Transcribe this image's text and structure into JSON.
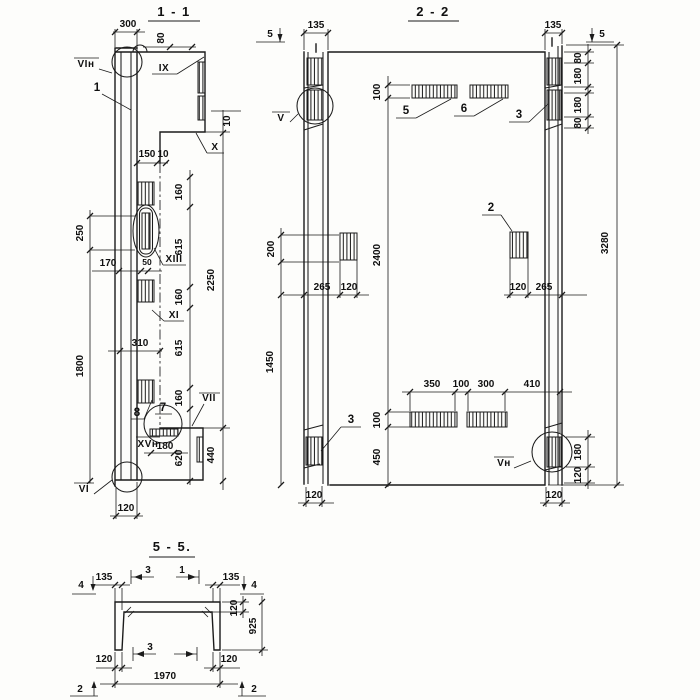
{
  "section_1_1": {
    "title": "1 - 1",
    "marks": {
      "vi_n": "VIн",
      "ix": "IX",
      "x": "X",
      "xiii": "XIII",
      "xi": "XI",
      "vii": "VII",
      "xv_n": "XVн",
      "vi": "VI"
    },
    "parts": {
      "p1": "1",
      "p7": "7",
      "p8": "8"
    },
    "dims": {
      "w300": "300",
      "h80": "80",
      "w150": "150",
      "w10": "10",
      "h10": "10",
      "h160a": "160",
      "h615a": "615",
      "h160b": "160",
      "h615b": "615",
      "h160c": "160",
      "h620": "620",
      "h2250": "2250",
      "h440": "440",
      "v250": "250",
      "v1800": "1800",
      "w170": "170",
      "w50": "50",
      "w310": "310",
      "w180": "180",
      "w120": "120"
    }
  },
  "section_2_2": {
    "title": "2 - 2",
    "marks": {
      "v": "V",
      "v_n": "Vн"
    },
    "parts": {
      "p5": "5",
      "p6": "6",
      "p3_top": "3",
      "p2": "2",
      "p3_bottom": "3"
    },
    "cut_marks": {
      "c5_left": "5",
      "c5_right": "5"
    },
    "dims": {
      "w135_l": "135",
      "w135_r": "135",
      "h80a": "80",
      "h180a": "180",
      "h180b": "180",
      "h80b": "80",
      "v3280": "3280",
      "v100_top": "100",
      "v2400": "2400",
      "v100_bot": "100",
      "v450": "450",
      "v200": "200",
      "w265a": "265",
      "w120a": "120",
      "w120b": "120",
      "w265b": "265",
      "v1450": "1450",
      "w350": "350",
      "w100": "100",
      "w300": "300",
      "w410": "410",
      "h180c": "180",
      "h120c": "120",
      "w120_bl": "120",
      "w120_br": "120"
    }
  },
  "section_5_5": {
    "title": "5 - 5.",
    "cut_marks": {
      "c4_left": "4",
      "c4_right": "4",
      "c3_top": "3",
      "c1_top": "1",
      "c3_bottom": "3",
      "c2_left": "2",
      "c2_right": "2"
    },
    "dims": {
      "w135_l": "135",
      "w135_r": "135",
      "h120": "120",
      "h925": "925",
      "w120_l": "120",
      "w120_r": "120",
      "w1970": "1970"
    }
  }
}
